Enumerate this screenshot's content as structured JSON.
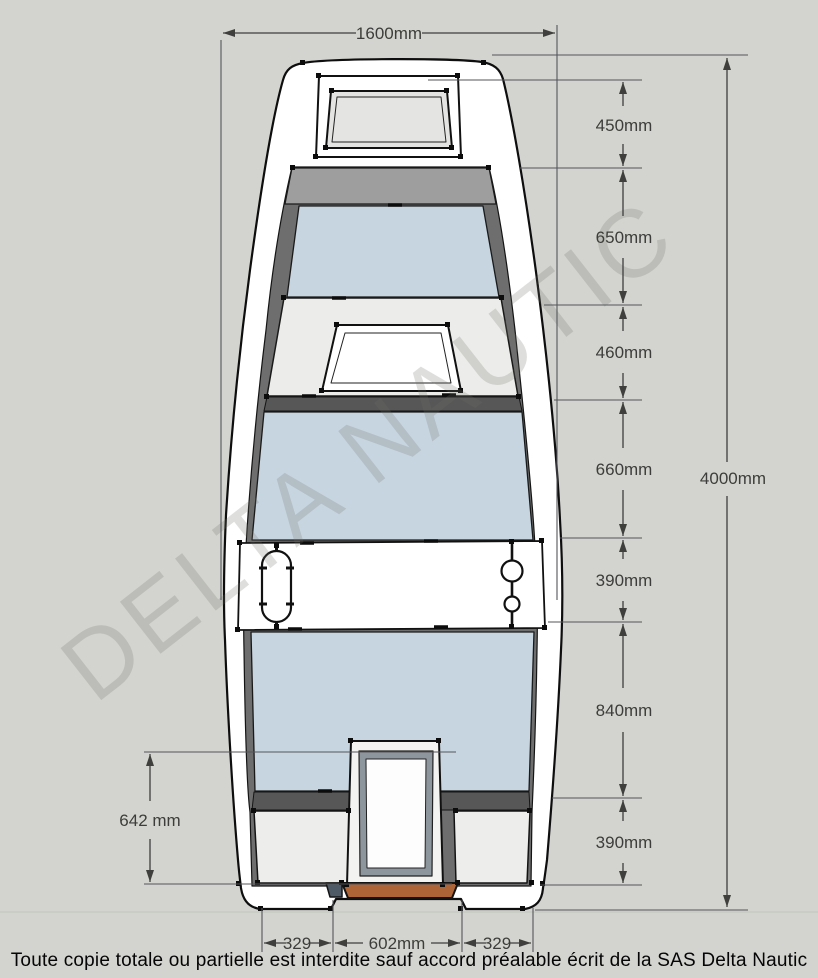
{
  "watermark": "DELTA NAUTIC",
  "footer": {
    "notice": "Toute copie totale ou partielle est interdite sauf accord préalable écrit de la SAS Delta Nautic"
  },
  "dimensions": {
    "overall_width": "1600mm",
    "overall_length": "4000mm",
    "stern_depth": "642 mm",
    "right_chain": [
      {
        "label": "450mm"
      },
      {
        "label": "650mm"
      },
      {
        "label": "460mm"
      },
      {
        "label": "660mm"
      },
      {
        "label": "390mm"
      },
      {
        "label": "840mm"
      },
      {
        "label": "390mm"
      }
    ],
    "bottom": [
      {
        "label": "329"
      },
      {
        "label": "602mm"
      },
      {
        "label": "329"
      }
    ]
  },
  "colors": {
    "background": "#d3d4cf",
    "hull": "#ffffff",
    "floor_blue": "#c7d5e0",
    "bench_gray": "#ececea",
    "wall_dark": "#6e6e6e",
    "bulkhead_gray": "#9e9e9e",
    "transom_wood": "#ad6436",
    "dimension_line": "#4c4c4a"
  }
}
